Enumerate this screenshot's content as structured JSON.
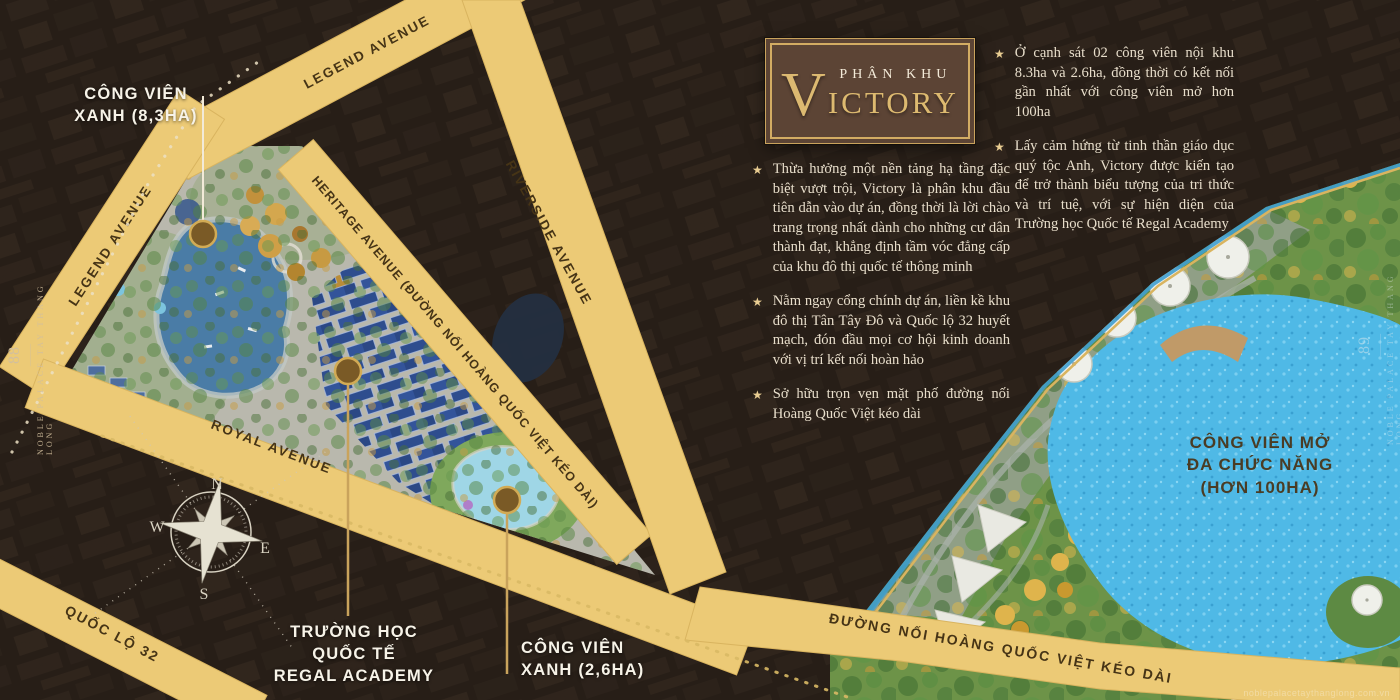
{
  "page": {
    "left_number": "88",
    "right_number": "89",
    "side_label": "NOBLE PALACE TAY THANG LONG",
    "watermark": "noblepalacetaythanglong.com.vn"
  },
  "title_box": {
    "kicker": "PHÂN KHU",
    "name_initial": "V",
    "name_rest": "ICTORY"
  },
  "glyphs": {
    "star": "★"
  },
  "intro_bullets": [
    {
      "text": "Thừa hưởng một nền tảng hạ tầng đặc biệt vượt trội, Victory là phân khu đầu tiên dẫn vào dự án, đồng thời là lời chào trang trọng nhất dành cho những cư dân thành đạt, khẳng định tầm vóc đẳng cấp của khu đô thị quốc tế thông minh"
    },
    {
      "text": "Nằm ngay cổng chính dự án, liền kề khu đô thị Tân Tây Đô và Quốc lộ 32 huyết mạch, đón đầu mọi cơ hội kinh doanh với vị trí kết nối hoàn hảo"
    },
    {
      "text": "Sở hữu trọn vẹn mặt phố đường nối Hoàng Quốc Việt kéo dài"
    }
  ],
  "feature_bullets": [
    {
      "text": "Ở cạnh sát 02 công viên nội khu 8.3ha và 2.6ha, đồng thời có kết nối gần nhất với công viên mở hơn 100ha"
    },
    {
      "text": "Lấy cảm hứng từ tinh thần giáo dục quý tộc Anh, Victory được kiến tạo để trở thành biểu tượng của tri thức và trí tuệ, với sự hiện diện của Trường học Quốc tế Regal Academy"
    }
  ],
  "map": {
    "roads": {
      "legend_top": "LEGEND AVENUE",
      "legend_left": "LEGEND AVENUE",
      "heritage": "HERITAGE AVENUE (ĐƯỜNG NỐI HOÀNG QUỐC VIỆT KÉO DÀI)",
      "riverside": "RIVERSIDE AVENUE",
      "royal": "ROYAL AVENUE",
      "ql32": "QUỐC LỘ 32",
      "hqv": "ĐƯỜNG NỐI HOÀNG QUỐC VIỆT KÉO DÀI"
    },
    "poi": {
      "park_83": {
        "line1": "CÔNG VIÊN",
        "line2": "XANH (8,3HA)"
      },
      "school": {
        "line1": "TRƯỜNG HỌC",
        "line2": "QUỐC TẾ",
        "line3": "REGAL ACADEMY"
      },
      "park_26": {
        "line1": "CÔNG VIÊN",
        "line2": "XANH (2,6HA)"
      },
      "open_park": {
        "line1": "CÔNG VIÊN MỞ",
        "line2": "ĐA CHỨC NĂNG",
        "line3": "(HƠN 100HA)"
      }
    },
    "compass": {
      "n": "N",
      "e": "E",
      "s": "S",
      "w": "W"
    }
  },
  "colors": {
    "road_gold": "#ecca76",
    "accent_gold": "#c9a35c",
    "text_cream": "#e8decb",
    "lake_blue": "#4fb9e6",
    "park_green": "#6d9348",
    "background": "#271e17"
  }
}
